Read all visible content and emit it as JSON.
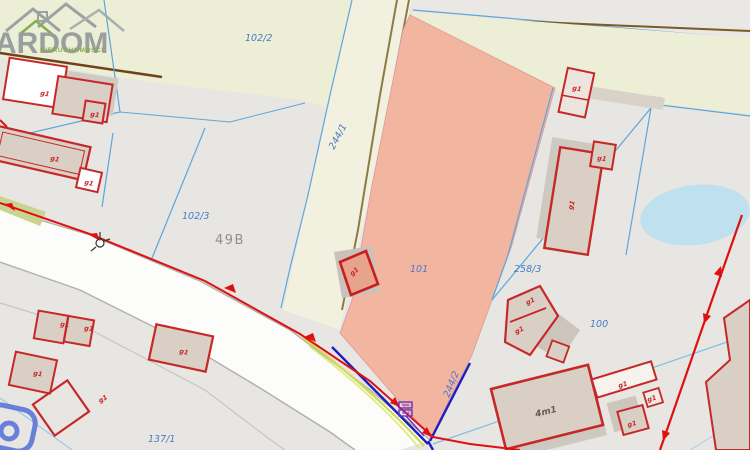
{
  "watermark": {
    "brand": "ARDOM",
    "subtitle": "NIERUCHOMOŚCI"
  },
  "map": {
    "street_number": "49B",
    "parcel_labels": [
      {
        "text": "102/2"
      },
      {
        "text": "244/1"
      },
      {
        "text": "102/3"
      },
      {
        "text": "101"
      },
      {
        "text": "258/3"
      },
      {
        "text": "100"
      },
      {
        "text": "244/2"
      },
      {
        "text": "137/1"
      }
    ],
    "building_labels": [
      {
        "text": "g1"
      },
      {
        "text": "g1"
      },
      {
        "text": "g1"
      },
      {
        "text": "g1"
      },
      {
        "text": "g1"
      },
      {
        "text": "g1"
      },
      {
        "text": "g1"
      },
      {
        "text": "g1"
      },
      {
        "text": "g1"
      },
      {
        "text": "g1"
      },
      {
        "text": "g1"
      },
      {
        "text": "g1"
      },
      {
        "text": "g1"
      },
      {
        "text": "g1"
      },
      {
        "text": "g1"
      },
      {
        "text": "4m1"
      },
      {
        "text": "g1"
      },
      {
        "text": "g1"
      },
      {
        "text": "g1"
      }
    ],
    "colors": {
      "highlight_parcel": "#f2b5a0",
      "boundary_blue": "#5ca6db",
      "dimension_red": "#e01010",
      "building_red": "#c62828",
      "utility_navy": "#1e1ec0",
      "field_green": "#edeed6",
      "water": "#bfe0ee",
      "parcel_label_blue": "#4b79c8"
    }
  }
}
